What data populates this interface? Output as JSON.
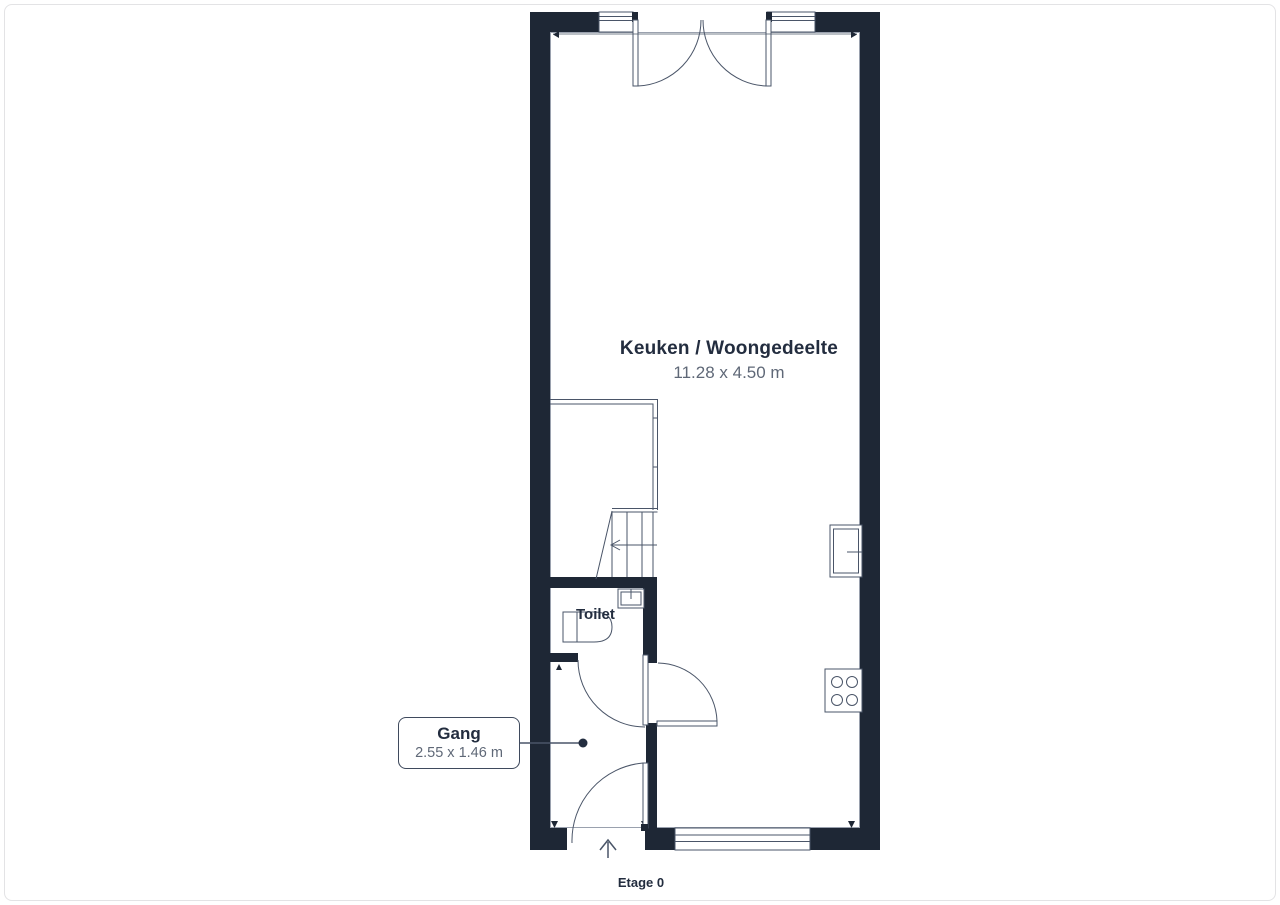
{
  "floorplan": {
    "floor_label": "Etage 0",
    "main_room": {
      "name": "Keuken / Woongedeelte",
      "dimensions": "11.28 x 4.50 m"
    },
    "toilet": {
      "name": "Toilet"
    },
    "hallway": {
      "name": "Gang",
      "dimensions": "2.55 x 1.46 m"
    },
    "colors": {
      "wall": "#1e2735",
      "line": "#4a5568",
      "line_muted": "#9aa1ae",
      "text_dark": "#232d3f",
      "text_muted": "#5f6877",
      "callout_border": "#3f4a5d",
      "page_border": "#e3e3e5"
    }
  }
}
